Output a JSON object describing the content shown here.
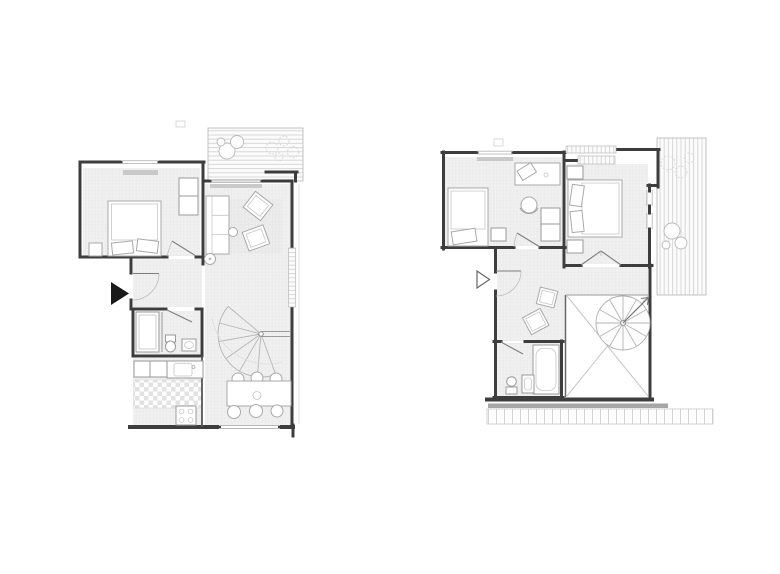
{
  "document": {
    "type": "architectural floor plan drawing",
    "plan_count": 2,
    "background": "#ffffff"
  },
  "colors": {
    "wall": "#3d3d3d",
    "partition": "#565656",
    "thin_line": "#9a9a9a",
    "furniture_stroke": "#a9a9a9",
    "floor_fill": "#f0f0f0",
    "floor_grid_line": "#e4e4e4",
    "deck_line": "#d0d0d0",
    "window_sill": "#c9c9c9",
    "checker_tile": "#e2e2e2",
    "entrance_arrow_filled": "#1a1a1a",
    "entrance_arrow_outline": "#666666",
    "void_cross_line": "#c6c6c6",
    "edge_band": "#a6a6a6"
  },
  "plans": [
    {
      "id": "lower-floor",
      "label": "Lower floor plan",
      "entrance_marker": "filled-triangle",
      "rooms": [
        "bedroom",
        "entry-hall",
        "bathroom",
        "kitchen",
        "living-room",
        "dining-area",
        "roof-terrace-top",
        "spiral-stair"
      ]
    },
    {
      "id": "upper-floor",
      "label": "Upper floor plan",
      "entrance_marker": "outline-triangle",
      "rooms": [
        "bedroom-1",
        "bedroom-2",
        "hall",
        "bathroom",
        "void-with-spiral-stair",
        "terrace-right",
        "eaves-band-bottom"
      ]
    }
  ]
}
